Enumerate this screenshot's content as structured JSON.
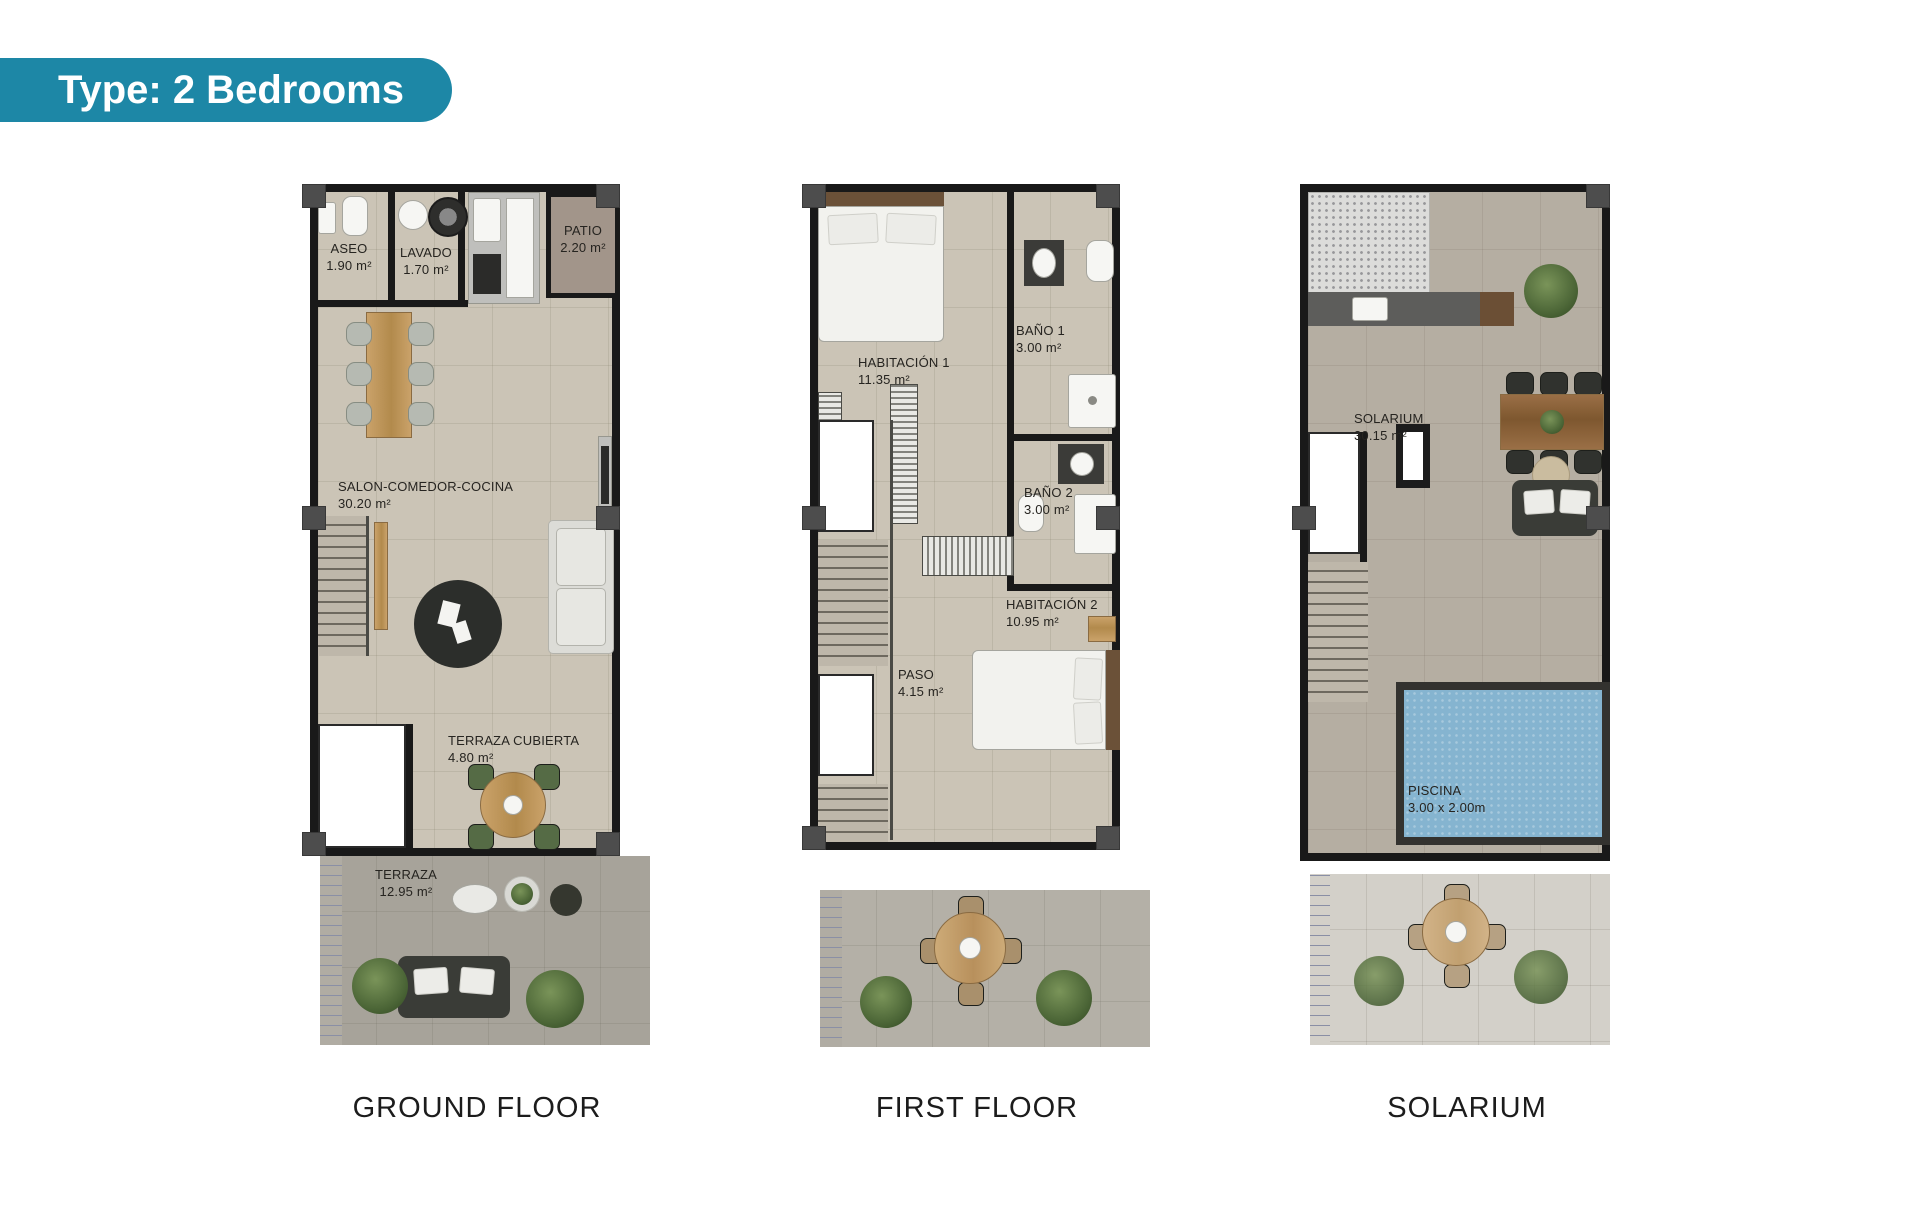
{
  "badge": {
    "label": "Type: 2 Bedrooms"
  },
  "colors": {
    "accent": "#1d87a6",
    "wall": "#191919",
    "floor_tile": "#cbc4b6",
    "terrace": "#a7a39a",
    "patio": "#a2958a",
    "pool_water": "#85b4d0",
    "wood": "#b28a4c",
    "plant": "#4c6637"
  },
  "floors": [
    {
      "id": "ground",
      "caption": "GROUND FLOOR",
      "rooms": {
        "aseo": {
          "label": "ASEO",
          "area": "1.90 m²"
        },
        "lavado": {
          "label": "LAVADO",
          "area": "1.70 m²"
        },
        "patio": {
          "label": "PATIO",
          "area": "2.20 m²"
        },
        "salon": {
          "label": "SALON-COMEDOR-COCINA",
          "area": "30.20 m²"
        },
        "cubierta": {
          "label": "TERRAZA CUBIERTA",
          "area": "4.80 m²"
        },
        "terraza": {
          "label": "TERRAZA",
          "area": "12.95 m²"
        }
      }
    },
    {
      "id": "first",
      "caption": "FIRST FLOOR",
      "rooms": {
        "hab1": {
          "label": "HABITACIÓN 1",
          "area": "11.35 m²"
        },
        "bano1": {
          "label": "BAÑO 1",
          "area": "3.00 m²"
        },
        "bano2": {
          "label": "BAÑO 2",
          "area": "3.00 m²"
        },
        "hab2": {
          "label": "HABITACIÓN 2",
          "area": "10.95 m²"
        },
        "paso": {
          "label": "PASO",
          "area": "4.15 m²"
        }
      }
    },
    {
      "id": "solarium",
      "caption": "SOLARIUM",
      "rooms": {
        "solarium": {
          "label": "SOLARIUM",
          "area": "30.15 m²"
        },
        "piscina": {
          "label": "PISCINA",
          "area": "3.00 x 2.00m"
        }
      }
    }
  ]
}
